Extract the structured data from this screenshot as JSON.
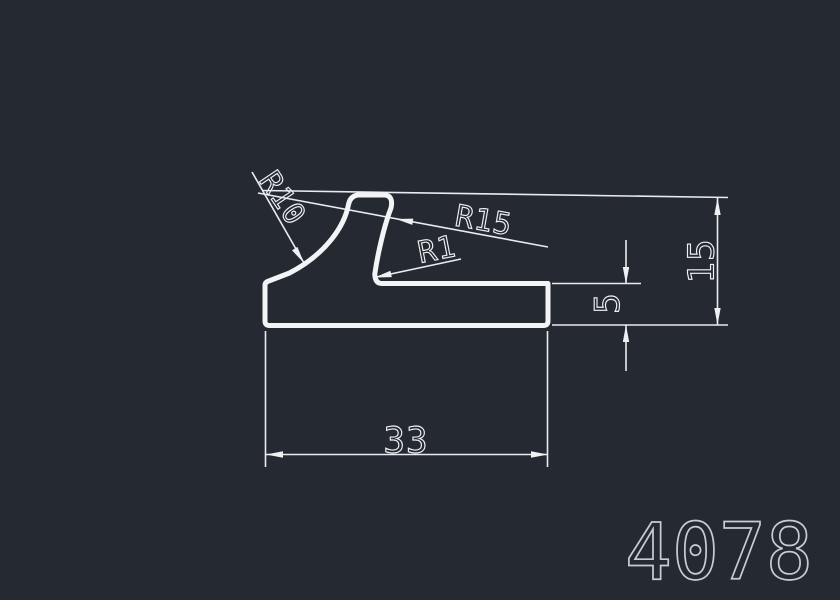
{
  "drawing": {
    "part_number": "4078",
    "labels": {
      "r10": "R10",
      "r15": "R15",
      "r1": "R1",
      "height": "15",
      "thickness": "5",
      "width": "33"
    },
    "colors": {
      "background": "#242932",
      "lines": "#eef0f2",
      "part_number": "#c8ccd2"
    }
  }
}
